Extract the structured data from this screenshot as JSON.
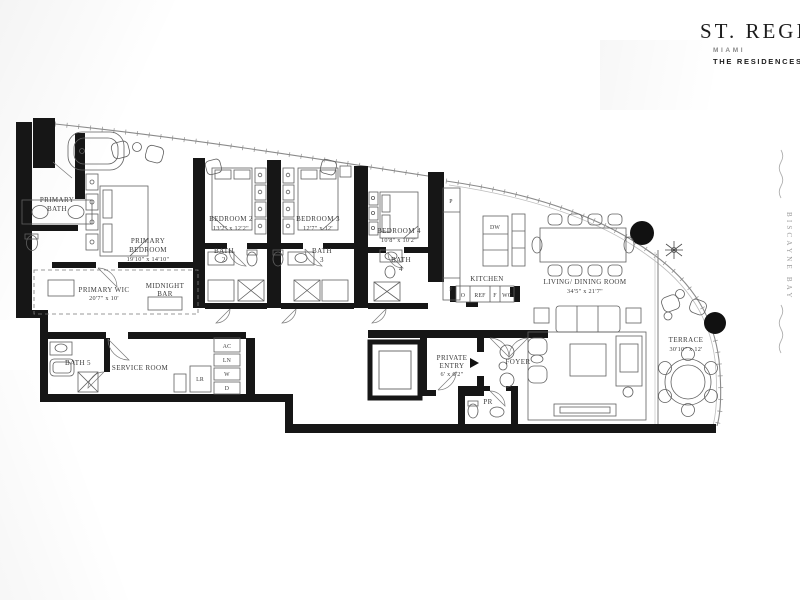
{
  "brand": {
    "name": "ST. REGIS",
    "city": "MIAMI",
    "subtitle": "THE RESIDENCES"
  },
  "water": {
    "label": "BISCAYNE BAY"
  },
  "rooms": [
    {
      "id": "primary-bath",
      "lines": [
        "PRIMARY",
        "BATH"
      ]
    },
    {
      "id": "primary-bedroom",
      "lines": [
        "PRIMARY",
        "BEDROOM",
        "19'10\" x 14'10\""
      ]
    },
    {
      "id": "bedroom-2",
      "lines": [
        "BEDROOM 2",
        "13'2\" x 12'2\""
      ]
    },
    {
      "id": "bath-2",
      "lines": [
        "BATH",
        "2"
      ]
    },
    {
      "id": "bedroom-3",
      "lines": [
        "BEDROOM 3",
        "12'7\" x 12'"
      ]
    },
    {
      "id": "bath-3",
      "lines": [
        "BATH",
        "3"
      ]
    },
    {
      "id": "bedroom-4",
      "lines": [
        "BEDROOM 4",
        "10'8\" x 10'2\""
      ]
    },
    {
      "id": "bath-4",
      "lines": [
        "BATH",
        "4"
      ]
    },
    {
      "id": "kitchen",
      "lines": [
        "KITCHEN"
      ]
    },
    {
      "id": "living-dining",
      "lines": [
        "LIVING/ DINING ROOM",
        "34'5\" x 21'7\""
      ]
    },
    {
      "id": "terrace",
      "lines": [
        "TERRACE",
        "30'10\" x 12'"
      ]
    },
    {
      "id": "primary-wic",
      "lines": [
        "PRIMARY WIC",
        "20'7\" x 10'"
      ]
    },
    {
      "id": "midnight-bar",
      "lines": [
        "MIDNIGHT",
        "BAR"
      ]
    },
    {
      "id": "bath-5",
      "lines": [
        "BATH 5"
      ]
    },
    {
      "id": "service-room",
      "lines": [
        "SERVICE ROOM"
      ]
    },
    {
      "id": "private-entry",
      "lines": [
        "PRIVATE",
        "ENTRY",
        "6' x 6'2\""
      ]
    },
    {
      "id": "foyer",
      "lines": [
        "FOYER"
      ]
    },
    {
      "id": "powder-room",
      "lines": [
        "PR"
      ]
    }
  ],
  "fixtures": {
    "dw": "DW",
    "pantry_upper": "P",
    "pantry_lower": "P",
    "oven": "O",
    "refrigerator": "REF",
    "freezer": "F",
    "wine_cooler": "WC",
    "ac": "AC",
    "linen": "LN",
    "washer": "W",
    "dryer": "D",
    "lr": "LR"
  },
  "colors": {
    "wall": "#161616",
    "furniture_line": "#606060",
    "glass_line": "#8a8a8a",
    "label_text": "#3c3c3c"
  }
}
